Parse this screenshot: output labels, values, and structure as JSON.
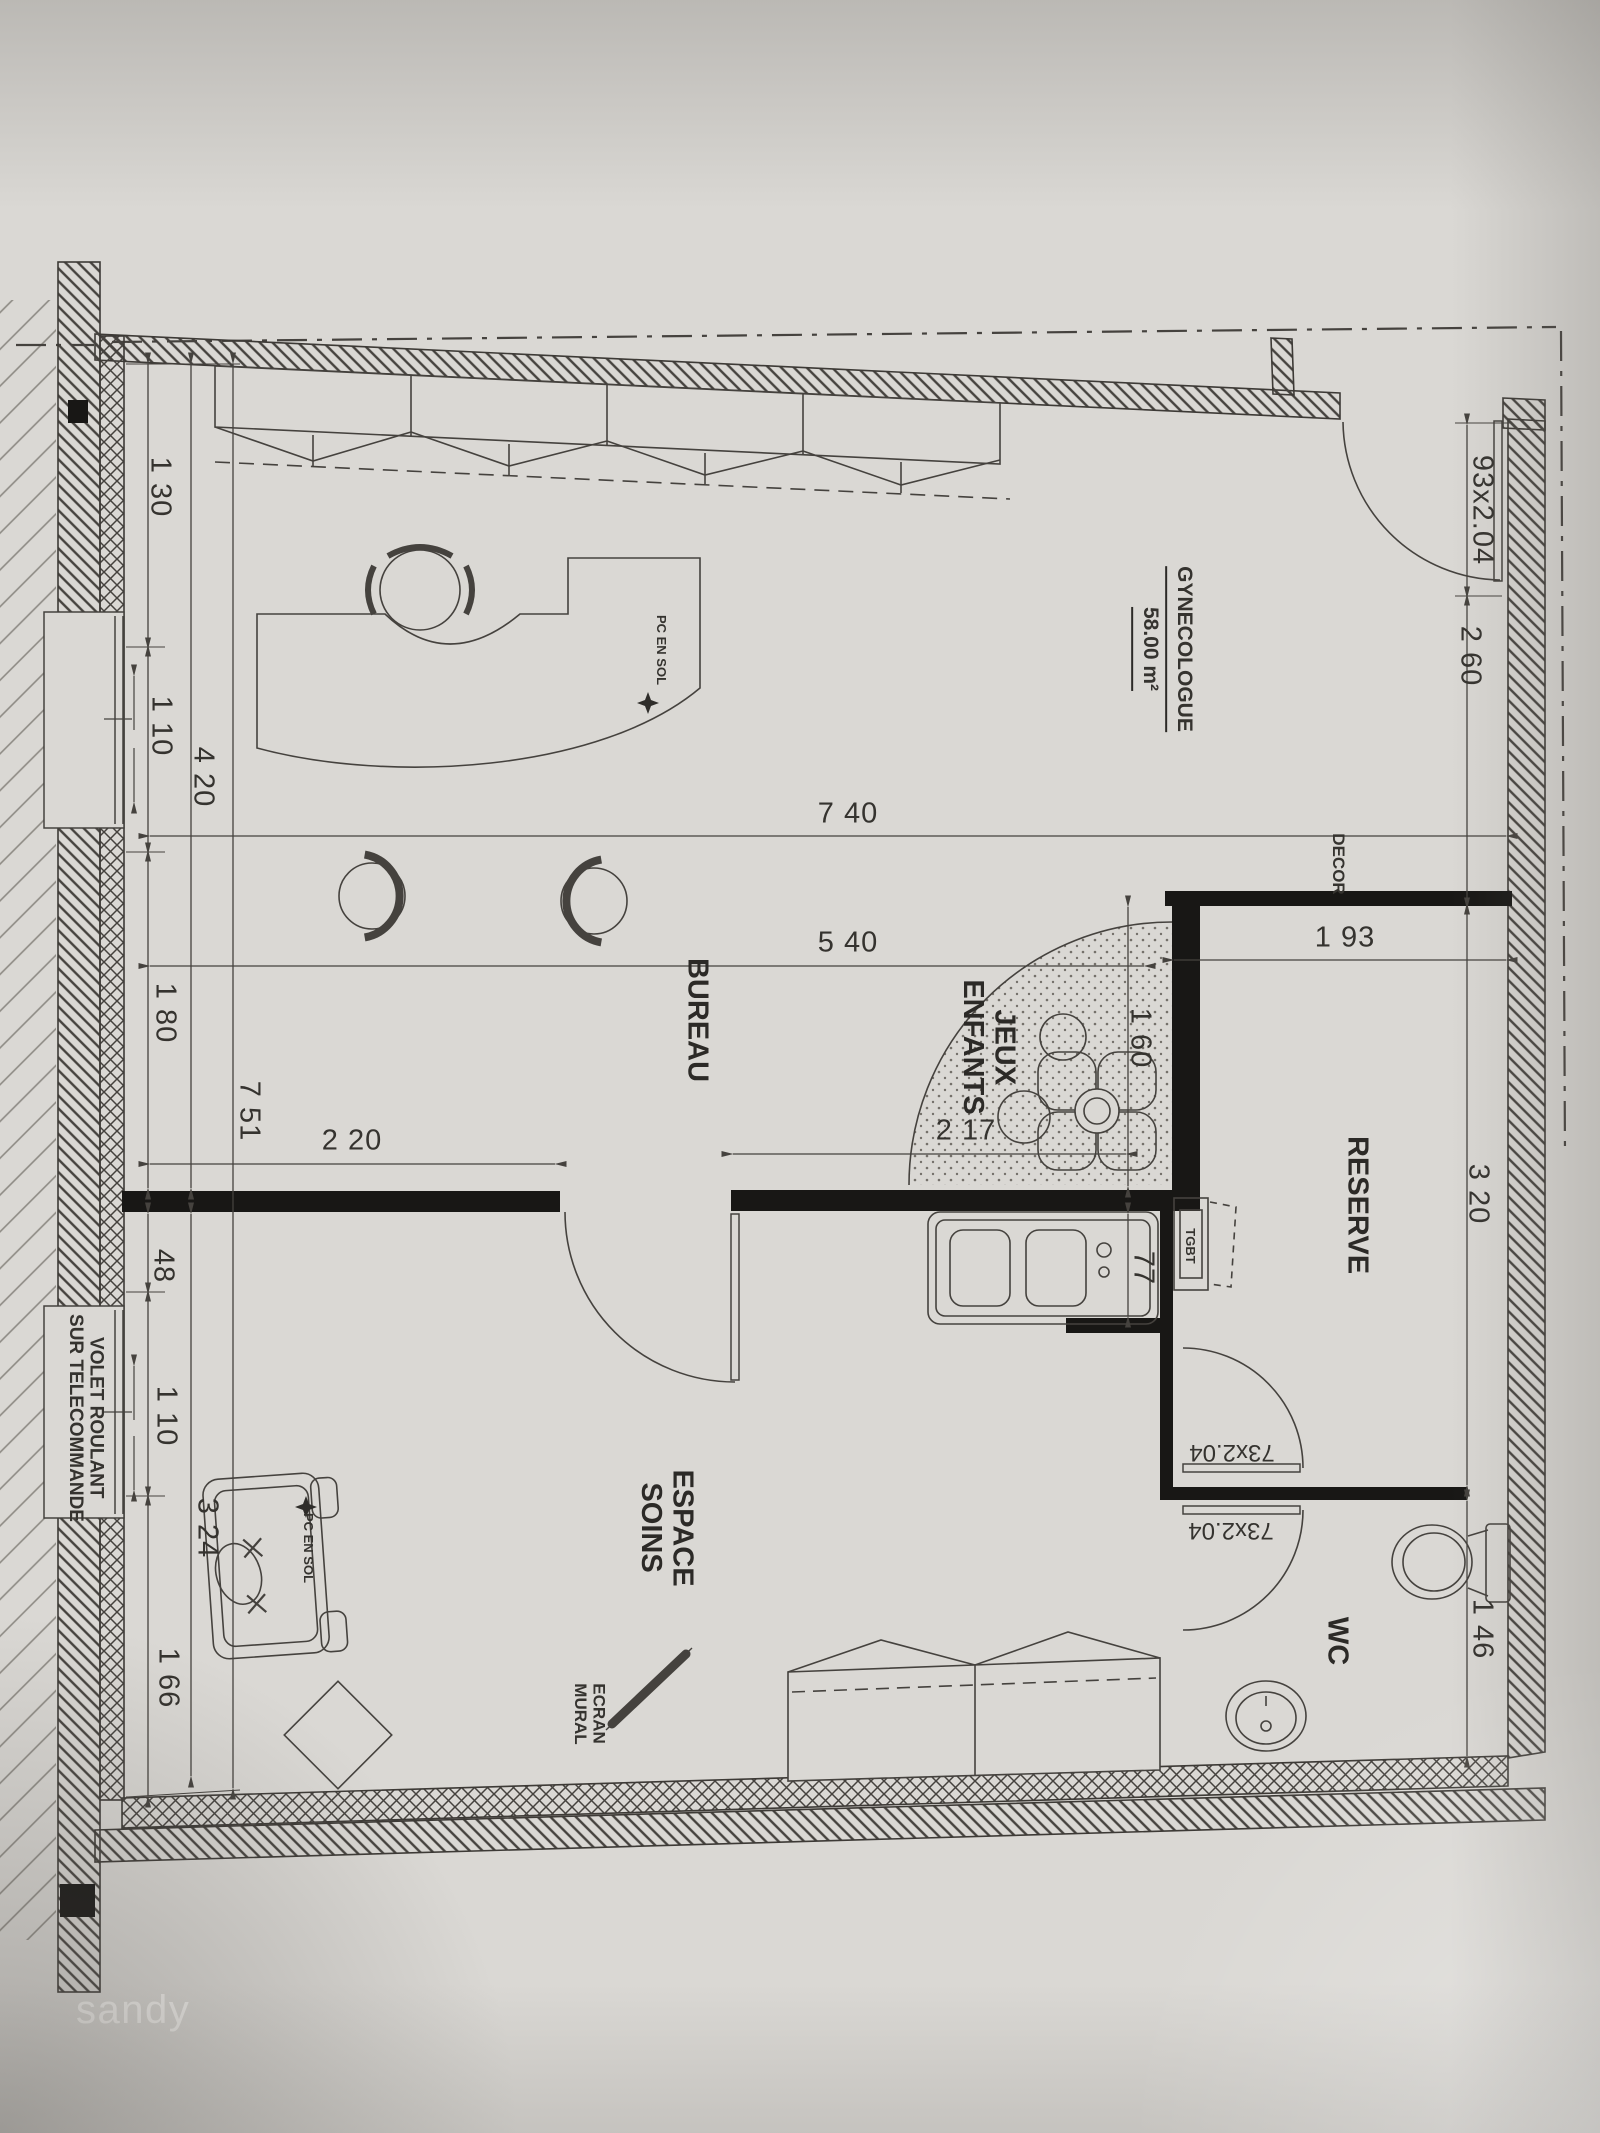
{
  "document": {
    "type": "floor-plan-photo",
    "watermark": "sandy"
  },
  "colors": {
    "paper": "#dad8d4",
    "ink": "#45423e",
    "wall_black": "#181715",
    "watermark_text": "#f6f5f2"
  },
  "labels": {
    "room_gynecologue": "GYNECOLOGUE",
    "room_gynecologue_area": "58.00 m²",
    "room_bureau": "BUREAU",
    "room_espace_soins": "ESPACE\nSOINS",
    "room_jeux_enfants": "JEUX\nENFANTS",
    "room_reserve": "RESERVE",
    "room_wc": "WC",
    "decor": "DECOR",
    "tgbt": "TGBT",
    "volet": "VOLET ROULANT\nSUR TELECOMMANDE",
    "ecran_mural": "ECRAN\nMURAL",
    "pc_en_sol": "PC EN SOL",
    "dim_130": "1 30",
    "dim_110_top": "1 10",
    "dim_420": "4 20",
    "dim_180": "1 80",
    "dim_751": "7 51",
    "dim_48": "48",
    "dim_110_bottom": "1 10",
    "dim_324": "3 24",
    "dim_166": "1 66",
    "dim_740": "7 40",
    "dim_540": "5 40",
    "dim_193": "1 93",
    "dim_220": "2 20",
    "dim_217": "2 17",
    "dim_160": "1 60",
    "dim_77": "77",
    "dim_260": "2 60",
    "dim_320": "3 20",
    "dim_146": "1 46",
    "door_entry_size": "93x2.04",
    "door_wc_size_upper": "73x2.04",
    "door_wc_size_lower": "73x2.04",
    "watermark": "sandy"
  }
}
